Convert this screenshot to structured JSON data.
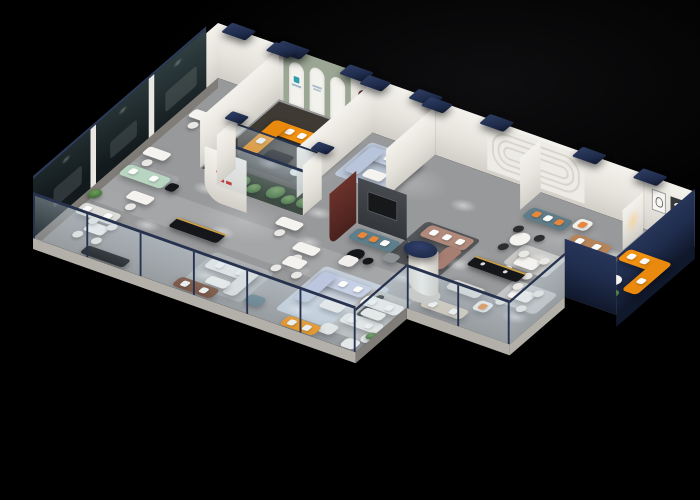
{
  "scene": {
    "description": "Isometric 3D cutaway render of a furniture showroom floor plan on a black background",
    "view": "dollhouse aerial view, roof removed"
  },
  "palette": {
    "background": "#000000",
    "floor": "#98999b",
    "floor_dark": "#3f3a34",
    "navy": "#1f2c4c",
    "navy_dark": "#10182b",
    "orange": "#f29111",
    "orange_light": "#ffb53a",
    "light_blue": "#c3cfe2",
    "lavender": "#c7d1e6",
    "mauve": "#b18a7c",
    "teal": "#5f7e8b",
    "caramel": "#b5845a",
    "brown": "#74452e",
    "mint": "#b8d5c2",
    "beige": "#d4cabb",
    "white_sofa": "#f1f1ef",
    "black_furn": "#151619",
    "gold": "#c89f4a",
    "plant_green": "#4c7a42",
    "sage": "#9ba794",
    "maroon": "#5e2c26",
    "red_logo": "#c2241e",
    "arch_teal": "#2e9db0",
    "rug_blue": "#bcc8d9",
    "rug_dark": "#54575a"
  },
  "items": {
    "floor": "Showroom floor slab",
    "back_wall": "Back display wall",
    "arch_display": "Arched brand display wall",
    "arch_logo": "Teal brand mark on arch panel",
    "groove_wall": "Decorative grooved wall panel",
    "maroon_niche": "Dark red arched niche",
    "art_frames": "Wall art frames",
    "dark_glass": "Tinted glass showcase wall",
    "front_glass": "Glass balustrade with navy rail",
    "plant_atrium": "Glass planter atrium",
    "cylinder": "Cylindrical column with navy cap",
    "column_cap": "Navy ceiling cap tile",
    "tv_partition": "Media wall partition",
    "maroon_panel": "Dark red accent partition",
    "red_logo": "Red brand emblem on curved partition",
    "orange_sofa_lounge": "Orange sectional sofa",
    "orange_sofa_wing": "Orange sectional sofa",
    "orange_sofa_front": "Orange sofa",
    "blue_sectional": "Light blue sectional sofa",
    "lavender_sectional": "Lavender sectional sofa",
    "mauve_sectional": "Mauve sectional sofa",
    "teal_sofa": "Teal sofa with orange pillows",
    "teal_gray_sofa": "Slate blue sofa with orange pillows",
    "caramel_sofa": "Caramel leather sofa",
    "brown_sofa": "Brown leather sofa",
    "mint_sofa": "Mint green sofa",
    "white_sofa": "White fabric sofa",
    "beige_sofa": "Beige sofa",
    "gray_sofa": "Light gray sofa",
    "armchair": "Accent armchair",
    "console_gold": "Black sideboard with brass trim",
    "console_black": "Black media console",
    "dining_set": "Dining table with chairs",
    "desk_set": "Office desk with task chair",
    "coffee_table": "Coffee table",
    "ottoman": "Teal ottoman",
    "pouf": "Gray pouf",
    "plant": "Potted plant",
    "downlight": "Downlight pool on floor",
    "lamp_glow": "Warm display lamp",
    "walkway": "Main walkway"
  }
}
